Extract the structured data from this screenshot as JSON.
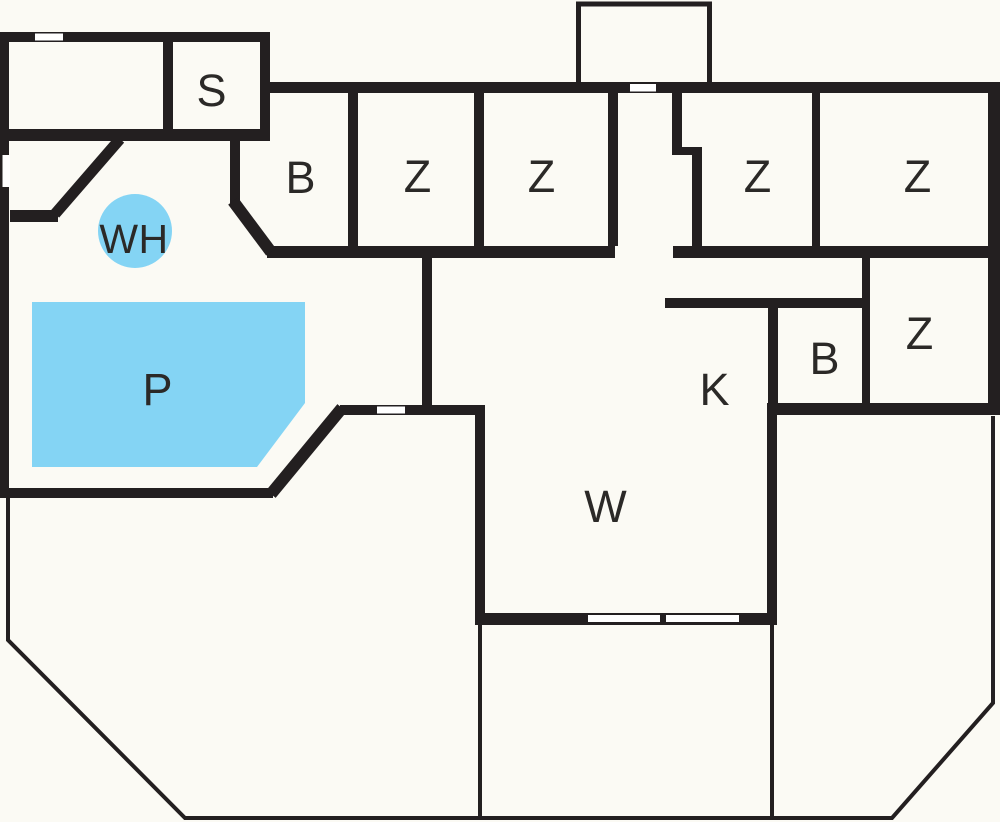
{
  "floor_plan": {
    "colors": {
      "background": "#fbfaf4",
      "wall": "#231f20",
      "outline": "#231f20",
      "water": "#84d4f4",
      "label_text": "#2b2927",
      "door_gap": "#ffffff"
    },
    "rooms": [
      {
        "id": "room-s",
        "label": "S"
      },
      {
        "id": "room-b-top",
        "label": "B"
      },
      {
        "id": "room-z-1",
        "label": "Z"
      },
      {
        "id": "room-z-2",
        "label": "Z"
      },
      {
        "id": "room-z-3",
        "label": "Z"
      },
      {
        "id": "room-z-4",
        "label": "Z"
      },
      {
        "id": "circle-wh",
        "label": "WH"
      },
      {
        "id": "pool-p",
        "label": "P"
      },
      {
        "id": "room-k",
        "label": "K"
      },
      {
        "id": "room-b-right",
        "label": "B"
      },
      {
        "id": "room-z-right",
        "label": "Z"
      },
      {
        "id": "room-w",
        "label": "W"
      }
    ]
  }
}
